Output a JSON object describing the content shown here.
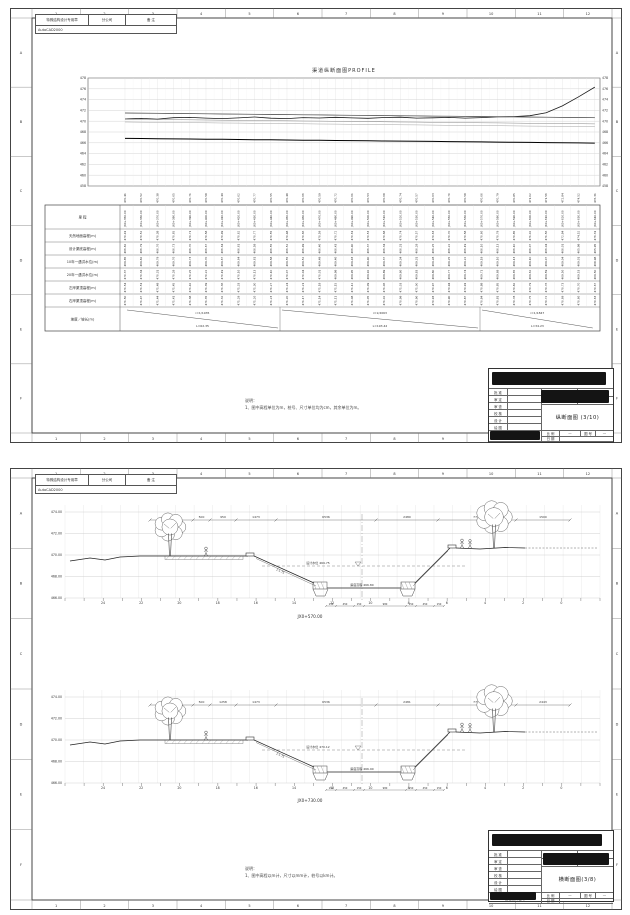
{
  "frame": {
    "columns": [
      "1",
      "2",
      "3",
      "4",
      "5",
      "6",
      "7",
      "8",
      "9",
      "10",
      "11",
      "12"
    ],
    "rows": [
      "A",
      "B",
      "C",
      "D",
      "E",
      "F"
    ]
  },
  "chart_data": {
    "type": "line",
    "title": "渠道纵断面图PROFILE",
    "xlabel": "里程",
    "ylabel": "高程(m)",
    "ylim": [
      458,
      478
    ],
    "yticks": [
      478,
      476,
      474,
      472,
      470,
      468,
      466,
      464,
      462,
      460,
      458
    ],
    "x_stations": [
      "JX0+350.00",
      "JX0+360.00",
      "JX0+370.00",
      "JX0+380.00",
      "JX0+390.00",
      "JX0+400.00",
      "JX0+410.00",
      "JX0+420.00",
      "JX0+430.00",
      "JX0+440.00",
      "JX0+450.00",
      "JX0+460.00",
      "JX0+470.00",
      "JX0+480.00",
      "JX0+490.00",
      "JX0+500.00",
      "JX0+510.00",
      "JX0+520.00",
      "JX0+530.00",
      "JX0+540.00",
      "JX0+550.00",
      "JX0+560.00",
      "JX0+570.00",
      "JX0+580.00",
      "JX0+590.00",
      "JX0+600.00",
      "JX0+610.00",
      "JX0+620.00",
      "JX0+630.00",
      "JX0+640.00"
    ],
    "series": [
      {
        "name": "天然地面高程",
        "values": [
          470.41,
          470.52,
          470.38,
          470.65,
          470.71,
          470.58,
          470.49,
          470.62,
          470.77,
          470.55,
          470.48,
          470.66,
          470.59,
          470.72,
          470.61,
          470.53,
          470.68,
          470.74,
          470.57,
          470.63,
          470.7,
          470.58,
          470.66,
          470.79,
          470.85,
          471.02,
          471.56,
          472.84,
          474.52,
          476.31
        ]
      },
      {
        "name": "设计渠底高程",
        "values": [
          466.82,
          466.79,
          466.76,
          466.73,
          466.7,
          466.67,
          466.64,
          466.61,
          466.58,
          466.55,
          466.52,
          466.49,
          466.46,
          466.43,
          466.4,
          466.37,
          466.34,
          466.31,
          466.28,
          466.25,
          466.22,
          466.19,
          466.16,
          466.13,
          466.1,
          466.07,
          466.04,
          466.01,
          465.98,
          465.95
        ]
      },
      {
        "name": "10年一遇洪水位",
        "values": [
          469.85,
          469.82,
          469.79,
          469.76,
          469.73,
          469.7,
          469.67,
          469.64,
          469.61,
          469.58,
          469.55,
          469.52,
          469.49,
          469.46,
          469.43,
          469.4,
          469.37,
          469.34,
          469.31,
          469.28,
          469.25,
          469.22,
          469.19,
          469.16,
          469.13,
          469.1,
          469.07,
          469.04,
          469.01,
          468.98
        ]
      },
      {
        "name": "20年一遇洪水位",
        "values": [
          470.37,
          470.34,
          470.31,
          470.28,
          470.25,
          470.22,
          470.19,
          470.16,
          470.13,
          470.1,
          470.07,
          470.04,
          470.01,
          469.98,
          469.95,
          469.92,
          469.89,
          469.86,
          469.83,
          469.8,
          469.77,
          469.74,
          469.71,
          469.68,
          469.65,
          469.62,
          469.59,
          469.56,
          469.53,
          469.5
        ]
      },
      {
        "name": "左岸渠顶高程",
        "values": [
          471.54,
          471.51,
          471.48,
          471.45,
          471.42,
          471.39,
          471.36,
          471.33,
          471.3,
          471.27,
          471.24,
          471.21,
          471.18,
          471.15,
          471.12,
          471.09,
          471.06,
          471.03,
          471.0,
          470.97,
          470.94,
          470.91,
          470.88,
          470.85,
          470.82,
          470.79,
          470.76,
          470.73,
          470.7,
          470.67
        ]
      },
      {
        "name": "右岸渠顶高程",
        "values": [
          471.5,
          471.47,
          471.44,
          471.41,
          471.38,
          471.35,
          471.32,
          471.29,
          471.26,
          471.23,
          471.2,
          471.17,
          471.14,
          471.11,
          471.08,
          471.05,
          471.02,
          470.99,
          470.96,
          470.93,
          470.9,
          470.87,
          470.84,
          470.81,
          470.78,
          470.75,
          470.72,
          470.69,
          470.66,
          470.63
        ]
      }
    ]
  },
  "sheet1": {
    "signoff": {
      "c1": "特殊结构设计专用章",
      "c2": "分公司",
      "c3": "备 注",
      "c4": "AutoCAD2000"
    },
    "title": "渠道纵断面图PROFILE",
    "table": {
      "headers": [
        "里  程",
        "天然地面高程(m)",
        "设计渠底高程(m)",
        "10年一遇洪水位(m)",
        "20年一遇洪水位(m)",
        "左岸渠顶高程(m)",
        "右岸渠顶高程(m)",
        "坡度／坡长(m)"
      ],
      "slopes": [
        {
          "i": "i=1/1935",
          "l": "L=62.35"
        },
        {
          "i": "i=1/2063",
          "l": "L=193.42"
        },
        {
          "i": "i=1/1847",
          "l": "L=34.23"
        }
      ]
    },
    "note": {
      "title": "说明：",
      "body": "1、图中高程单位为m，桩号、尺寸单位均为cm，其余单位为m。"
    },
    "titleblock": {
      "approval_rows": [
        "批 准",
        "审 定",
        "审 查",
        "校 核",
        "设 计",
        "绘 图"
      ],
      "small1": "专 业",
      "small2": "设 计",
      "small3": "阶 段",
      "small4": "技 施",
      "title": "纵断面图 (3/10)",
      "scale_label": "比 例",
      "scale": "—",
      "no_label": "图 号",
      "no": "—",
      "date_label": "日 期",
      "date": "",
      "cert": "工程设计证号"
    }
  },
  "sheet2": {
    "signoff": {
      "c1": "特殊结构设计专用章",
      "c2": "分公司",
      "c3": "备 注",
      "c4": "AutoCAD2000"
    },
    "sections": [
      {
        "station": "JX0+570.00",
        "elevations": [
          "474.00",
          "472.00",
          "470.00",
          "468.00",
          "466.00"
        ],
        "dims": [
          "1500",
          "500",
          "950",
          "1473",
          "6536",
          "2480",
          "7715",
          "1500"
        ],
        "foot_dims": [
          "150",
          "450",
          "150",
          "980",
          "150",
          "450",
          "150"
        ],
        "ruler": [
          "24",
          "22",
          "20",
          "18",
          "16",
          "14",
          "12",
          "10",
          "8",
          "6",
          "4",
          "2",
          "0"
        ],
        "water_label": "设计水位 469.75",
        "bottom_label": "渠底高程 466.80",
        "slope_label": "1:1.75"
      },
      {
        "station": "JX0+730.00",
        "elevations": [
          "474.00",
          "472.00",
          "470.00",
          "468.00",
          "466.00"
        ],
        "dims": [
          "1500",
          "500",
          "1258",
          "1473",
          "6536",
          "2481",
          "7734",
          "2443"
        ],
        "foot_dims": [
          "150",
          "450",
          "150",
          "980",
          "150",
          "450",
          "150"
        ],
        "ruler": [
          "24",
          "22",
          "20",
          "18",
          "16",
          "14",
          "12",
          "10",
          "8",
          "6",
          "4",
          "2",
          "0"
        ],
        "water_label": "设计水位 470.12",
        "bottom_label": "渠底高程 466.90",
        "slope_label": "1:1.75"
      }
    ],
    "note": {
      "title": "说明：",
      "body": "1、图中高程以m计，尺寸以mm计，桩号以km计。"
    },
    "titleblock": {
      "approval_rows": [
        "批 准",
        "审 定",
        "审 查",
        "校 核",
        "设 计",
        "绘 图"
      ],
      "small1": "专 业",
      "small2": "设 计",
      "small3": "阶 段",
      "small4": "技 施",
      "title": "横断面图(3/8)",
      "scale_label": "比 例",
      "scale": "—",
      "no_label": "图 号",
      "no": "—",
      "date_label": "日 期",
      "date": "",
      "cert": "工程设计证号"
    }
  }
}
